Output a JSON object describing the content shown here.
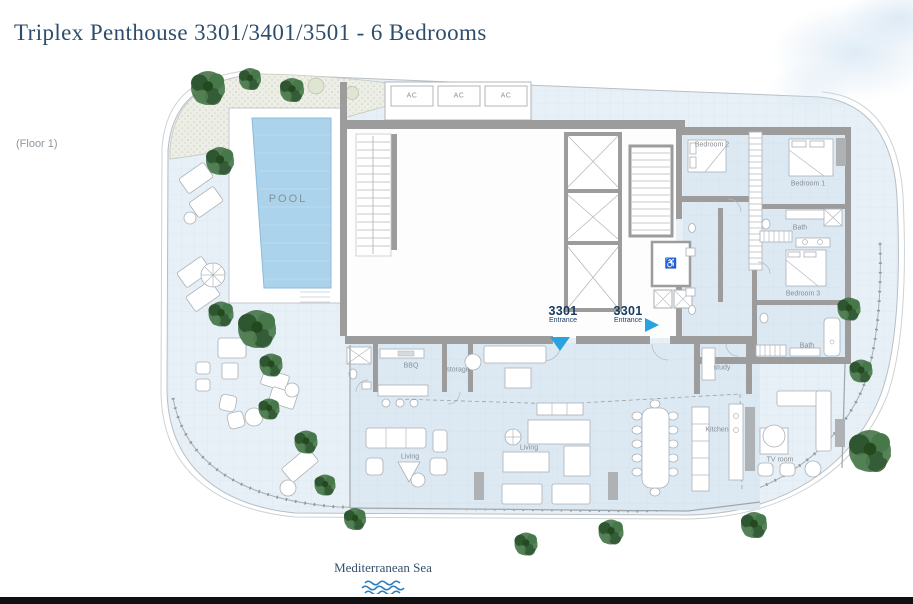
{
  "page": {
    "title": "Triplex Penthouse 3301/3401/3501 - 6 Bedrooms",
    "floor_label": "(Floor 1)",
    "sea_label": "Mediterranean Sea"
  },
  "plan": {
    "pool_label": "POOL",
    "ac_label": "AC",
    "wc_icon": "♿",
    "rooms": [
      {
        "id": "bedroom-2",
        "label": "Bedroom 2"
      },
      {
        "id": "bedroom-1",
        "label": "Bedroom 1"
      },
      {
        "id": "bath-upper",
        "label": "Bath"
      },
      {
        "id": "bedroom-3",
        "label": "Bedroom 3"
      },
      {
        "id": "bath-lower",
        "label": "Bath"
      },
      {
        "id": "study",
        "label": "study"
      },
      {
        "id": "bbq",
        "label": "BBQ"
      },
      {
        "id": "storage",
        "label": "storage"
      },
      {
        "id": "living-left",
        "label": "Living"
      },
      {
        "id": "living-right",
        "label": "Living"
      },
      {
        "id": "kitchen",
        "label": "Kitchen"
      },
      {
        "id": "tv-room",
        "label": "TV room"
      }
    ],
    "entrances": [
      {
        "unit": "3301",
        "label": "Entrance",
        "direction": "down"
      },
      {
        "unit": "3301",
        "label": "Entrance",
        "direction": "right"
      }
    ]
  },
  "colors": {
    "title_text": "#2e4d6b",
    "floor_text": "#8d97a0",
    "label_text": "#878e95",
    "entrance_text": "#16395e",
    "arrow": "#29a3e0",
    "wave": "#2b7fc0",
    "pool": "#abd3ec",
    "terrace": "#e7f0f6",
    "indoor": "#dce9f3",
    "wall": "#9c9c9c",
    "tree": "#3c6b3e"
  }
}
